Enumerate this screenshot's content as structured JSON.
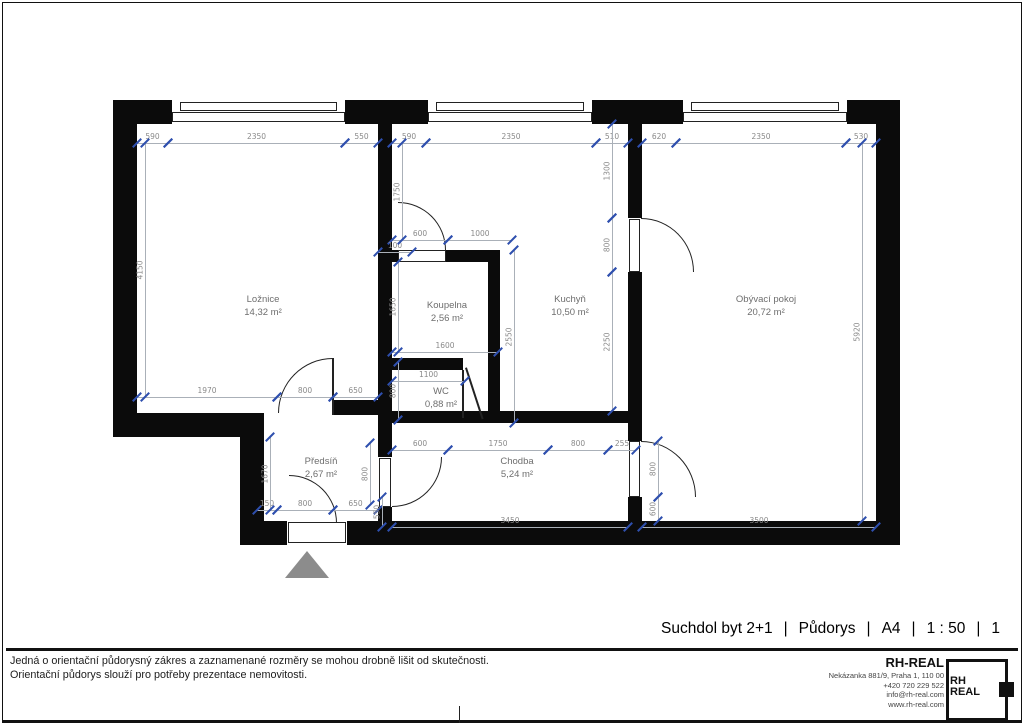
{
  "page": {
    "title_items": [
      "Suchdol byt 2+1",
      "Půdorys",
      "A4",
      "1 : 50",
      "1"
    ],
    "separator": "|",
    "disclaimer_line1": "Jedná o orientační půdorysný zákres a zaznamenané rozměry se mohou drobně lišit od skutečnosti.",
    "disclaimer_line2": "Orientační půdorys slouží pro potřeby prezentace nemovitosti.",
    "company": {
      "name": "RH-REAL",
      "address": "Nekázanka 881/9, Praha 1, 110 00",
      "phone": "+420 720 229 522",
      "email": "info@rh-real.com",
      "web": "www.rh-real.com",
      "logo_top": "RH",
      "logo_bottom": "REAL"
    }
  },
  "colors": {
    "wall": "#0b0b0b",
    "tick": "#2e4fae",
    "dim_line": "#aab0b8",
    "dim_text": "#8a8a8a",
    "room_text": "#6e6e6e",
    "triangle": "#8c8c8c",
    "door": "#222222"
  },
  "rooms": [
    {
      "name": "Ložnice",
      "area": "14,32 m²",
      "x": 263,
      "y": 306
    },
    {
      "name": "Koupelna",
      "area": "2,56 m²",
      "x": 447,
      "y": 312
    },
    {
      "name": "Kuchyň",
      "area": "10,50 m²",
      "x": 570,
      "y": 306
    },
    {
      "name": "Obývací pokoj",
      "area": "20,72 m²",
      "x": 766,
      "y": 306
    },
    {
      "name": "WC",
      "area": "0,88 m²",
      "x": 441,
      "y": 398
    },
    {
      "name": "Předsíň",
      "area": "2,67 m²",
      "x": 321,
      "y": 468
    },
    {
      "name": "Chodba",
      "area": "5,24 m²",
      "x": 517,
      "y": 468
    }
  ],
  "plan": {
    "walls": [
      [
        113,
        100,
        787,
        24
      ],
      [
        113,
        100,
        24,
        337
      ],
      [
        876,
        100,
        24,
        445
      ],
      [
        240,
        521,
        47,
        24
      ],
      [
        347,
        521,
        553,
        24
      ],
      [
        113,
        413,
        150,
        24
      ],
      [
        240,
        413,
        24,
        132
      ],
      [
        333,
        400,
        59,
        15
      ],
      [
        378,
        124,
        14,
        299
      ],
      [
        392,
        250,
        6,
        12
      ],
      [
        446,
        250,
        54,
        12
      ],
      [
        488,
        250,
        12,
        173
      ],
      [
        392,
        358,
        71,
        12
      ],
      [
        392,
        411,
        250,
        12
      ],
      [
        628,
        124,
        14,
        94
      ],
      [
        628,
        272,
        14,
        151
      ],
      [
        628,
        423,
        14,
        18
      ],
      [
        628,
        497,
        14,
        24
      ],
      [
        378,
        423,
        14,
        34
      ],
      [
        378,
        507,
        14,
        14
      ]
    ],
    "windows": [
      [
        172,
        100,
        173,
        24
      ],
      [
        428,
        100,
        164,
        24
      ],
      [
        683,
        100,
        164,
        24
      ]
    ],
    "door_leaves": [
      [
        398,
        250,
        48,
        12
      ],
      [
        629,
        219,
        11,
        53
      ],
      [
        629,
        441,
        11,
        56
      ],
      [
        379,
        458,
        12,
        49
      ],
      [
        288,
        522,
        58,
        21
      ]
    ],
    "door_arcs": [
      {
        "x": 278,
        "y": 358,
        "w": 55,
        "h": 55,
        "corner": "tl"
      },
      {
        "x": 398,
        "y": 202,
        "w": 48,
        "h": 48,
        "corner": "tr"
      },
      {
        "x": 641,
        "y": 218,
        "w": 53,
        "h": 54,
        "corner": "tr"
      },
      {
        "x": 641,
        "y": 441,
        "w": 55,
        "h": 56,
        "corner": "tr"
      },
      {
        "x": 392,
        "y": 457,
        "w": 50,
        "h": 50,
        "corner": "br"
      },
      {
        "x": 289,
        "y": 475,
        "w": 48,
        "h": 48,
        "corner": "tr"
      }
    ],
    "lines": [
      [
        332,
        358,
        2,
        57,
        0
      ],
      [
        462,
        370,
        2,
        48,
        0
      ],
      [
        465,
        368,
        2,
        54,
        -18
      ]
    ],
    "dims_h": [
      [
        137,
        168,
        143,
        "590"
      ],
      [
        168,
        345,
        143,
        "2350"
      ],
      [
        345,
        378,
        143,
        "550"
      ],
      [
        392,
        426,
        143,
        "590"
      ],
      [
        426,
        596,
        143,
        "2350"
      ],
      [
        596,
        628,
        143,
        "510"
      ],
      [
        642,
        676,
        143,
        "620"
      ],
      [
        676,
        846,
        143,
        "2350"
      ],
      [
        846,
        876,
        143,
        "530"
      ],
      [
        392,
        448,
        240,
        "600"
      ],
      [
        448,
        512,
        240,
        "1000"
      ],
      [
        378,
        412,
        252,
        "100"
      ],
      [
        392,
        498,
        352,
        "1600"
      ],
      [
        392,
        465,
        381,
        "1100"
      ],
      [
        137,
        277,
        397,
        "1970"
      ],
      [
        277,
        333,
        397,
        "800"
      ],
      [
        333,
        378,
        397,
        "650"
      ],
      [
        392,
        448,
        450,
        "600"
      ],
      [
        448,
        548,
        450,
        "1750"
      ],
      [
        548,
        608,
        450,
        "800"
      ],
      [
        608,
        636,
        450,
        "255"
      ],
      [
        257,
        277,
        510,
        "150"
      ],
      [
        277,
        333,
        510,
        "800"
      ],
      [
        333,
        378,
        510,
        "650"
      ],
      [
        392,
        628,
        527,
        "3450"
      ],
      [
        642,
        876,
        527,
        "3500"
      ]
    ],
    "dims_v": [
      [
        143,
        397,
        145,
        "4150"
      ],
      [
        143,
        240,
        402,
        "1750"
      ],
      [
        262,
        352,
        398,
        "1650"
      ],
      [
        362,
        420,
        398,
        "800"
      ],
      [
        250,
        423,
        514,
        "2550"
      ],
      [
        124,
        218,
        612,
        "1300"
      ],
      [
        218,
        272,
        612,
        "800"
      ],
      [
        272,
        411,
        612,
        "2250"
      ],
      [
        441,
        497,
        658,
        "800"
      ],
      [
        497,
        521,
        658,
        "600"
      ],
      [
        143,
        521,
        862,
        "5920"
      ],
      [
        437,
        510,
        270,
        "1670"
      ],
      [
        443,
        505,
        370,
        "800"
      ],
      [
        497,
        527,
        382,
        "550"
      ]
    ],
    "triangle": {
      "x": 285,
      "y": 551,
      "w": 44,
      "h": 27
    }
  }
}
